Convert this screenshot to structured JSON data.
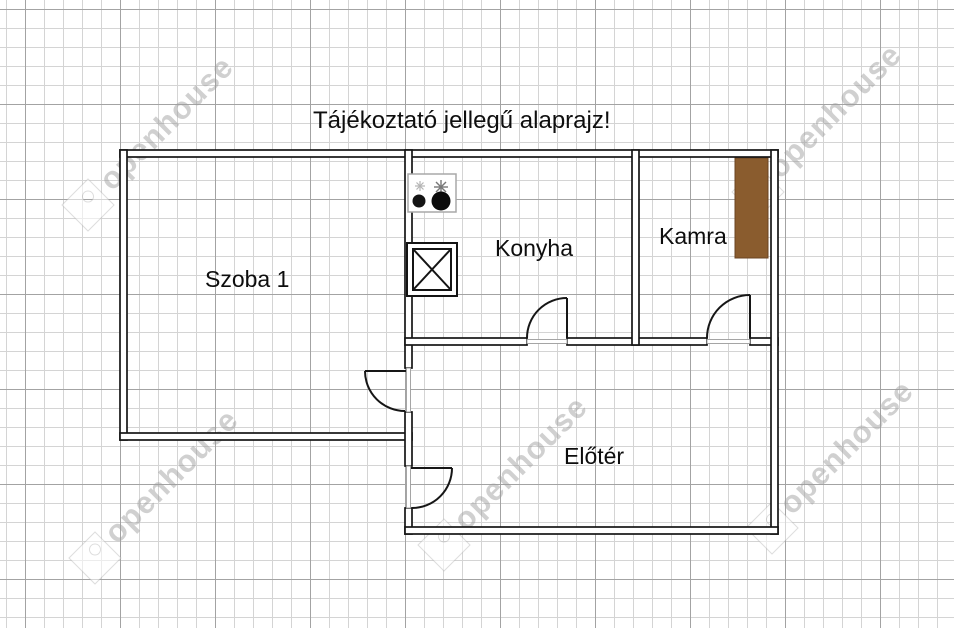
{
  "title": "Tájékoztató jellegű alaprajz!",
  "watermark": {
    "text": "openhouse"
  },
  "rooms": [
    {
      "id": "szoba1",
      "name": "Szoba 1"
    },
    {
      "id": "konyha",
      "name": "Konyha"
    },
    {
      "id": "kamra",
      "name": "Kamra"
    },
    {
      "id": "eloter",
      "name": "Előtér"
    }
  ],
  "icons": {
    "stove": "stove-icon",
    "chimney": "chimney-icon",
    "cabinet": "cabinet-rect",
    "door": "door-swing-icon"
  },
  "colors": {
    "wall": "#161616",
    "cabinet": "#8a5c2e",
    "cabinet_border": "#6b4423",
    "grid_minor": "#d4d4d4",
    "grid_major": "#a3a3a3",
    "watermark": "#9e9e9e"
  }
}
